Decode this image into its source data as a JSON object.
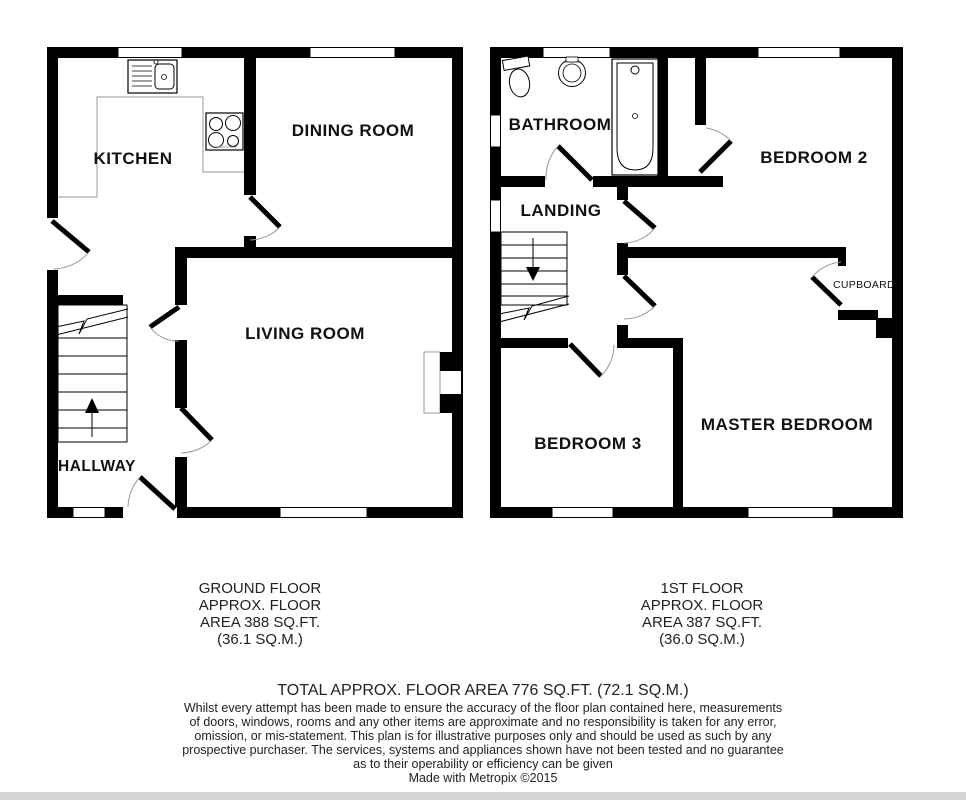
{
  "floors": {
    "ground": {
      "rooms": {
        "kitchen": "KITCHEN",
        "dining": "DINING ROOM",
        "living": "LIVING ROOM",
        "hallway": "HALLWAY"
      },
      "caption": [
        "GROUND FLOOR",
        "APPROX. FLOOR",
        "AREA 388 SQ.FT.",
        "(36.1 SQ.M.)"
      ]
    },
    "first": {
      "rooms": {
        "bathroom": "BATHROOM",
        "landing": "LANDING",
        "bedroom2": "BEDROOM 2",
        "cupboard": "CUPBOARD",
        "bedroom3": "BEDROOM 3",
        "master": "MASTER BEDROOM"
      },
      "caption": [
        "1ST FLOOR",
        "APPROX. FLOOR",
        "AREA 387 SQ.FT.",
        "(36.0 SQ.M.)"
      ]
    }
  },
  "summary": {
    "total": "TOTAL APPROX. FLOOR AREA 776 SQ.FT. (72.1 SQ.M.)",
    "disclaimer": [
      "Whilst every attempt has been made to ensure the accuracy of the floor plan contained here, measurements",
      "of doors, windows, rooms and any other items are approximate and no responsibility is taken for any error,",
      "omission, or mis-statement. This plan is for illustrative purposes only and should be used as such by any",
      "prospective purchaser. The services, systems and appliances shown have not been tested and no guarantee",
      "as to their operability or efficiency can be given"
    ],
    "credit": "Made with Metropix ©2015"
  },
  "colors": {
    "wall": "#000000",
    "thin_line": "#999999",
    "text": "#1a1a1a"
  }
}
